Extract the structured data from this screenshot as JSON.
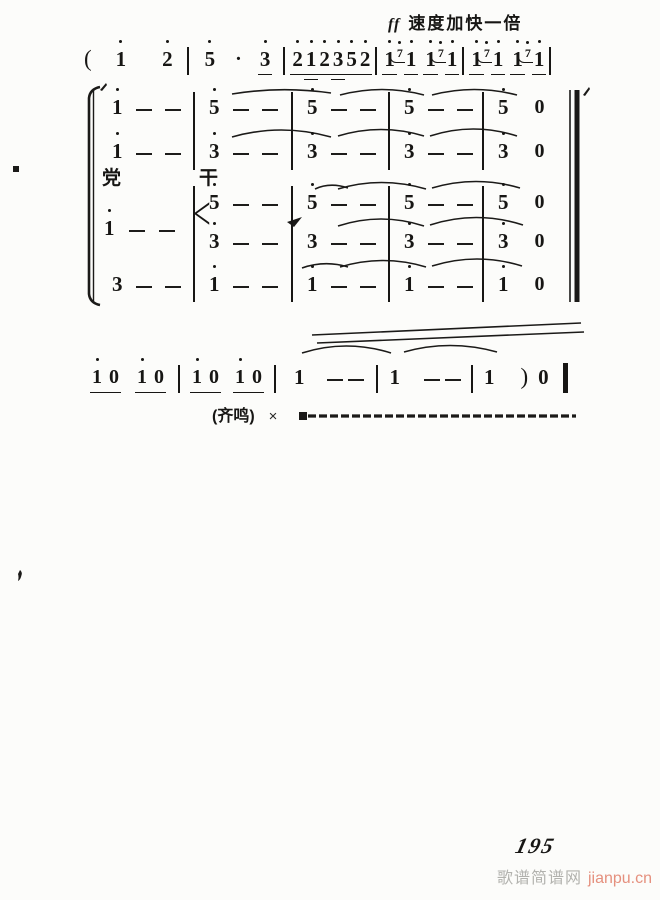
{
  "tempo": {
    "dynamic": "ff",
    "text": "速度加快一倍"
  },
  "line1_tokens": [
    {
      "k": "paren",
      "t": "(",
      "sp": 0
    },
    {
      "k": "n",
      "t": "1",
      "d": 1,
      "sp": 24
    },
    {
      "k": "n",
      "t": "2",
      "d": 1,
      "sp": 36
    },
    {
      "k": "bar",
      "sp": 14
    },
    {
      "k": "n",
      "t": "5",
      "d": 1,
      "sp": 16
    },
    {
      "k": "pdot",
      "t": "·",
      "sp": 20
    },
    {
      "k": "n",
      "t": "3",
      "d": 1,
      "u": 1,
      "sp": 18
    },
    {
      "k": "bar",
      "sp": 13
    },
    {
      "k": "n",
      "t": "2",
      "d": 1,
      "u": 1,
      "sp": 7
    },
    {
      "k": "n",
      "t": "1",
      "d": 1,
      "u": 2,
      "sp": 3
    },
    {
      "k": "n",
      "t": "2",
      "d": 1,
      "u": 1,
      "sp": 3
    },
    {
      "k": "n",
      "t": "3",
      "d": 1,
      "u": 2,
      "sp": 3
    },
    {
      "k": "n",
      "t": "5",
      "d": 1,
      "u": 1,
      "sp": 3
    },
    {
      "k": "n",
      "t": "2",
      "d": 1,
      "u": 1,
      "sp": 3
    },
    {
      "k": "bar",
      "sp": 5
    },
    {
      "k": "n",
      "t": "1",
      "d": 1,
      "u": 1,
      "sp": 7
    },
    {
      "k": "grace",
      "t": "7",
      "d": 1,
      "sp": 2
    },
    {
      "k": "n",
      "t": "1",
      "d": 1,
      "u": 1,
      "sp": 3
    },
    {
      "k": "n",
      "t": "1",
      "d": 1,
      "u": 1,
      "sp": 9
    },
    {
      "k": "grace",
      "t": "7",
      "d": 1,
      "sp": 2
    },
    {
      "k": "n",
      "t": "1",
      "d": 1,
      "u": 1,
      "sp": 3
    },
    {
      "k": "bar",
      "sp": 5
    },
    {
      "k": "n",
      "t": "1",
      "d": 1,
      "u": 1,
      "sp": 7
    },
    {
      "k": "grace",
      "t": "7",
      "d": 1,
      "sp": 2
    },
    {
      "k": "n",
      "t": "1",
      "d": 1,
      "u": 1,
      "sp": 3
    },
    {
      "k": "n",
      "t": "1",
      "d": 1,
      "u": 1,
      "sp": 9
    },
    {
      "k": "grace",
      "t": "7",
      "d": 1,
      "sp": 2
    },
    {
      "k": "n",
      "t": "1",
      "d": 1,
      "u": 1,
      "sp": 3
    },
    {
      "k": "bar",
      "sp": 5
    }
  ],
  "system": {
    "lyrics": [
      "党",
      "干"
    ],
    "voice3_head": {
      "note": "1",
      "octave_dot": true,
      "dashes": 2,
      "chord_mark": "<"
    },
    "rows": [
      {
        "name": "voice-1",
        "cells": [
          {
            "n": "1",
            "d": 1,
            "dash": 2
          },
          {
            "n": "5",
            "d": 1,
            "dash": 2
          },
          {
            "n": "5",
            "d": 1,
            "dash": 2
          },
          {
            "n": "5",
            "d": 1,
            "dash": 2
          },
          {
            "n": "5",
            "d": 1,
            "rest": "0"
          }
        ]
      },
      {
        "name": "voice-2",
        "cells": [
          {
            "n": "1",
            "d": 1,
            "dash": 2
          },
          {
            "n": "3",
            "d": 1,
            "dash": 2
          },
          {
            "n": "3",
            "d": 1,
            "dash": 2
          },
          {
            "n": "3",
            "d": 1,
            "dash": 2
          },
          {
            "n": "3",
            "d": 1,
            "rest": "0"
          }
        ]
      },
      {
        "name": "voice-3-upper",
        "cells": [
          null,
          {
            "n": "5",
            "d": 1,
            "dash": 2
          },
          {
            "n": "5",
            "d": 1,
            "dash": 2
          },
          {
            "n": "5",
            "d": 1,
            "dash": 2
          },
          {
            "n": "5",
            "d": 1,
            "rest": "0"
          }
        ]
      },
      {
        "name": "voice-3-lower",
        "cells": [
          null,
          {
            "n": "3",
            "d": 1,
            "dash": 2
          },
          {
            "n": "3",
            "d": 0,
            "dash": 2
          },
          {
            "n": "3",
            "d": 1,
            "dash": 2
          },
          {
            "n": "3",
            "d": 1,
            "rest": "0"
          }
        ]
      },
      {
        "name": "voice-4",
        "cells": [
          {
            "n": "3",
            "d": 0,
            "dash": 2
          },
          {
            "n": "1",
            "d": 1,
            "dash": 2
          },
          {
            "n": "1",
            "d": 1,
            "dash": 2
          },
          {
            "n": "1",
            "d": 1,
            "dash": 2
          },
          {
            "n": "1",
            "d": 1,
            "rest": "0"
          }
        ]
      }
    ]
  },
  "coda_tokens": [
    {
      "k": "pair",
      "a": "1",
      "b": "0",
      "sp": 0
    },
    {
      "k": "pair",
      "a": "1",
      "b": "0",
      "sp": 18
    },
    {
      "k": "bar",
      "sp": 14
    },
    {
      "k": "pair",
      "a": "1",
      "b": "0",
      "sp": 12
    },
    {
      "k": "pair",
      "a": "1",
      "b": "0",
      "sp": 16
    },
    {
      "k": "bar",
      "sp": 12
    },
    {
      "k": "n",
      "t": "1",
      "sp": 18
    },
    {
      "k": "dash",
      "sp": 22
    },
    {
      "k": "dash",
      "sp": 5
    },
    {
      "k": "bar",
      "sp": 12
    },
    {
      "k": "n",
      "t": "1",
      "sp": 12
    },
    {
      "k": "dash",
      "sp": 24
    },
    {
      "k": "dash",
      "sp": 5
    },
    {
      "k": "bar",
      "sp": 10
    },
    {
      "k": "n",
      "t": "1",
      "sp": 11
    },
    {
      "k": "paren",
      "t": ")",
      "sp": 26
    },
    {
      "k": "n",
      "t": "0",
      "sp": 10
    },
    {
      "k": "thickbar",
      "sp": 14
    }
  ],
  "tutti": {
    "label": "(齐鸣)",
    "times": "×"
  },
  "page_number": "195",
  "watermark": {
    "site": "歌谱简谱网",
    "domain": "jianpu.cn"
  }
}
